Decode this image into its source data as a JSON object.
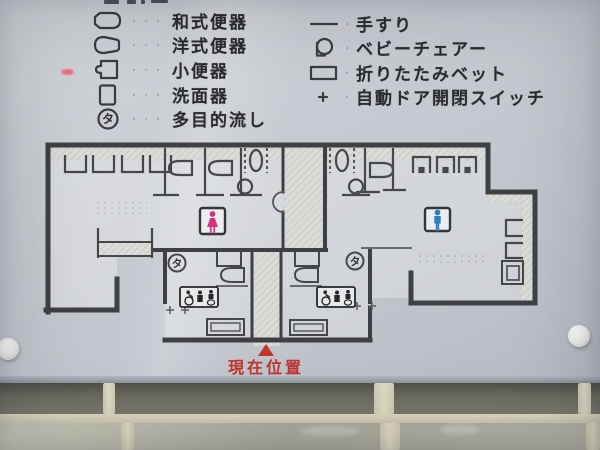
{
  "sign": {
    "type": "restroom-floor-plan-tactile-sign",
    "legend": {
      "left": [
        {
          "icon": "squat-toilet",
          "label": "和式便器"
        },
        {
          "icon": "western-toilet",
          "label": "洋式便器"
        },
        {
          "icon": "urinal",
          "label": "小便器"
        },
        {
          "icon": "washbasin",
          "label": "洗面器"
        },
        {
          "icon": "multipurpose-sink",
          "label": "多目的流し"
        }
      ],
      "right": [
        {
          "icon": "handrail",
          "label": "手すり"
        },
        {
          "icon": "baby-chair",
          "label": "ベビーチェアー"
        },
        {
          "icon": "folding-bed",
          "label": "折りたたみベット"
        },
        {
          "icon": "auto-door-switch",
          "label": "自動ドア開閉スイッチ"
        }
      ]
    },
    "map": {
      "current_location_label": "現在位置",
      "multipurpose_sink_symbol": "タ",
      "womens_room_symbol": "female-pictogram",
      "mens_room_symbol": "male-pictogram"
    },
    "colors": {
      "female_pink": "#d6317f",
      "male_blue": "#2e7cc4",
      "current_location_red": "#bf3430",
      "wall": "#3f4044",
      "panel": "#c7cad0"
    }
  }
}
